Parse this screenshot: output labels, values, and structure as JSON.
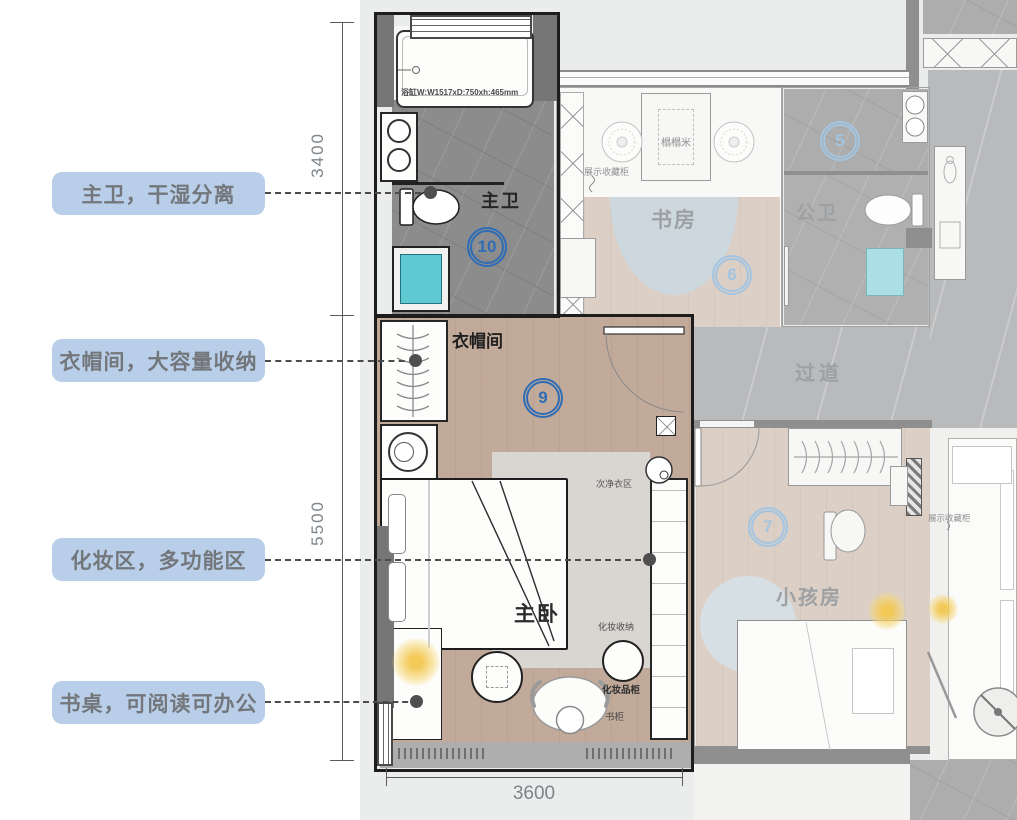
{
  "annotations": {
    "pills": [
      {
        "label": "主卫，干湿分离"
      },
      {
        "label": "衣帽间，大容量收纳"
      },
      {
        "label": "化妆区，多功能区"
      },
      {
        "label": "书桌，可阅读可办公"
      }
    ]
  },
  "dimensions": {
    "top_left": "3400",
    "bottom_left": "5500",
    "bottom": "3600"
  },
  "rooms": {
    "master_bath": "主卫",
    "cloakroom": "衣帽间",
    "master_bedroom": "主卧",
    "study": "书房",
    "public_bath": "公卫",
    "corridor": "过道",
    "kids_room": "小孩房"
  },
  "markers": {
    "k5": "5",
    "k6": "6",
    "k7": "7",
    "k9": "9",
    "k10": "10"
  },
  "furniture": {
    "bathtub_spec": "浴缸W:W1517xD:750xh:465mm",
    "tatami": "榻榻米",
    "display_cabinet_study": "展示收藏柜",
    "display_cabinet_living": "展示收藏柜",
    "secondary_clothes_area": "次净衣区",
    "makeup_storage": "化妆收纳",
    "cosmetics_cabinet": "化妆品柜",
    "bookshelf": "书柜"
  },
  "colors": {
    "pill_bg": "#b9cfe9",
    "pill_text": "#73777c",
    "marker_strong": "#2e6db6",
    "marker_faded": "#a3c5e2",
    "wood_floor": "#c2aa9a",
    "teal_fixture": "#5fc9d3"
  }
}
